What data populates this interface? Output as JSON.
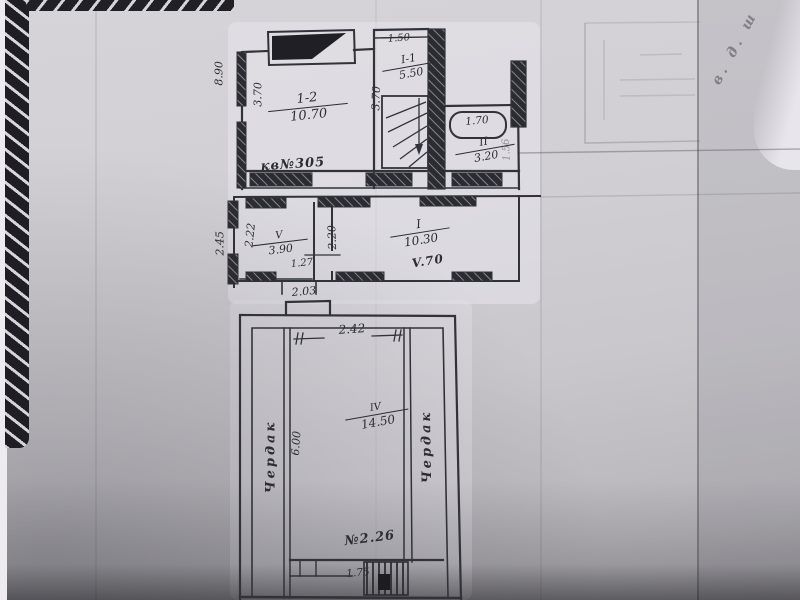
{
  "photo": {
    "corner_note": "в. д. ш"
  },
  "upper": {
    "dim_outer_left": "8.90",
    "room12_dim_left": "3.70",
    "room12_label": "1-2",
    "room12_area": "10.70",
    "room12_note": "кв№305",
    "roomI1_dim_top": "1.50",
    "roomI1_label": "I-1",
    "roomI1_area": "5.50",
    "roomI1_dim_left": "3.70",
    "tub_dim": "1.70",
    "tub_dim_right": "1.56",
    "roomII_label": "II",
    "roomII_area": "3.20"
  },
  "middle": {
    "dim_outer_left": "2.45",
    "roomV_dim_left": "2.22",
    "roomV_label": "V",
    "roomV_area": "3.90",
    "partition_dim": "2.20",
    "door_dim": "1.27",
    "roomI_label": "I",
    "roomI_area": "10.30",
    "roomI_note": "V.70",
    "door_bottom_dim": "2.03"
  },
  "lower": {
    "dim_top": "2.42",
    "roomIV_label": "IV",
    "roomIV_area": "14.50",
    "dim_left": "6.00",
    "attic_left": "Чердак",
    "attic_right": "Чердак",
    "note": "№2.26",
    "dim_bottom": "1.75"
  }
}
